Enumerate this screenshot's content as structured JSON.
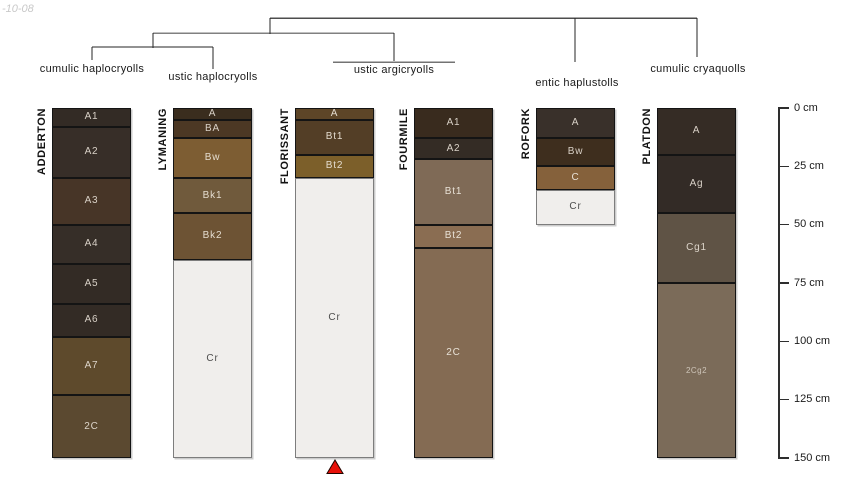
{
  "watermark": "-10-08",
  "dendrogram": {
    "groups": [
      {
        "label": "cumulic haplocryolls",
        "x": 92,
        "y": 63
      },
      {
        "label": "ustic haplocryolls",
        "x": 213,
        "y": 71
      },
      {
        "label": "ustic argicryolls",
        "x": 394,
        "y": 64
      },
      {
        "label": "entic haplustolls",
        "x": 577,
        "y": 77
      },
      {
        "label": "cumulic cryaquolls",
        "x": 698,
        "y": 63
      }
    ]
  },
  "profiles": [
    {
      "name": "ADDERTON",
      "x": 52,
      "group": "cumulic haplocryolls",
      "horizons": [
        {
          "label": "A1",
          "top_cm": 0,
          "bottom_cm": 8,
          "color": "#332b25",
          "label_color": "#d9d1c7"
        },
        {
          "label": "A2",
          "top_cm": 8,
          "bottom_cm": 30,
          "color": "#372e28",
          "label_color": "#d9d1c7"
        },
        {
          "label": "A3",
          "top_cm": 30,
          "bottom_cm": 50,
          "color": "#473527",
          "label_color": "#d9d1c7"
        },
        {
          "label": "A4",
          "top_cm": 50,
          "bottom_cm": 67,
          "color": "#362e28",
          "label_color": "#d9d1c7"
        },
        {
          "label": "A5",
          "top_cm": 67,
          "bottom_cm": 84,
          "color": "#332b25",
          "label_color": "#d9d1c7"
        },
        {
          "label": "A6",
          "top_cm": 84,
          "bottom_cm": 98,
          "color": "#332b25",
          "label_color": "#d9d1c7"
        },
        {
          "label": "A7",
          "top_cm": 98,
          "bottom_cm": 123,
          "color": "#5e4a2c",
          "label_color": "#ddd5ca"
        },
        {
          "label": "2C",
          "top_cm": 123,
          "bottom_cm": 150,
          "color": "#5b4930",
          "label_color": "#ddd5ca"
        }
      ]
    },
    {
      "name": "LYMANING",
      "x": 173,
      "group": "ustic haplocryolls",
      "horizons": [
        {
          "label": "A",
          "top_cm": 0,
          "bottom_cm": 5,
          "color": "#3a2d1e",
          "label_color": "#d9d1c7"
        },
        {
          "label": "BA",
          "top_cm": 5,
          "bottom_cm": 13,
          "color": "#4c3824",
          "label_color": "#d9d1c7"
        },
        {
          "label": "Bw",
          "top_cm": 13,
          "bottom_cm": 30,
          "color": "#7d5d33",
          "label_color": "#e4dccf"
        },
        {
          "label": "Bk1",
          "top_cm": 30,
          "bottom_cm": 45,
          "color": "#705a3c",
          "label_color": "#e4dccf"
        },
        {
          "label": "Bk2",
          "top_cm": 45,
          "bottom_cm": 65,
          "color": "#6d5334",
          "label_color": "#e4dccf"
        },
        {
          "label": "Cr",
          "top_cm": 65,
          "bottom_cm": 150,
          "color": "#f0eeec",
          "label_color": "#4d4d4d"
        }
      ]
    },
    {
      "name": "FLORISSANT",
      "x": 295,
      "group": "ustic argicryolls",
      "horizons": [
        {
          "label": "A",
          "top_cm": 0,
          "bottom_cm": 5,
          "color": "#5d4527",
          "label_color": "#e4dccf"
        },
        {
          "label": "Bt1",
          "top_cm": 5,
          "bottom_cm": 20,
          "color": "#533e26",
          "label_color": "#e4dccf"
        },
        {
          "label": "Bt2",
          "top_cm": 20,
          "bottom_cm": 30,
          "color": "#7c5f2a",
          "label_color": "#e4dccf"
        },
        {
          "label": "Cr",
          "top_cm": 30,
          "bottom_cm": 150,
          "color": "#f0eeec",
          "label_color": "#4d4d4d"
        }
      ]
    },
    {
      "name": "FOURMILE",
      "x": 414,
      "group": "ustic argicryolls",
      "horizons": [
        {
          "label": "A1",
          "top_cm": 0,
          "bottom_cm": 13,
          "color": "#392b1e",
          "label_color": "#d9d1c7"
        },
        {
          "label": "A2",
          "top_cm": 13,
          "bottom_cm": 22,
          "color": "#342c25",
          "label_color": "#d9d1c7"
        },
        {
          "label": "Bt1",
          "top_cm": 22,
          "bottom_cm": 50,
          "color": "#7f6a56",
          "label_color": "#e8e1d6"
        },
        {
          "label": "Bt2",
          "top_cm": 50,
          "bottom_cm": 60,
          "color": "#8a6d52",
          "label_color": "#e8e1d6"
        },
        {
          "label": "2C",
          "top_cm": 60,
          "bottom_cm": 150,
          "color": "#846b53",
          "label_color": "#e8e1d6"
        }
      ]
    },
    {
      "name": "ROFORK",
      "x": 536,
      "group": "entic haplustolls",
      "horizons": [
        {
          "label": "A",
          "top_cm": 0,
          "bottom_cm": 13,
          "color": "#39302a",
          "label_color": "#d9d1c7"
        },
        {
          "label": "Bw",
          "top_cm": 13,
          "bottom_cm": 25,
          "color": "#3e2e1e",
          "label_color": "#d9d1c7"
        },
        {
          "label": "C",
          "top_cm": 25,
          "bottom_cm": 35,
          "color": "#85613b",
          "label_color": "#e8e1d6"
        },
        {
          "label": "Cr",
          "top_cm": 35,
          "bottom_cm": 50,
          "color": "#f0eeec",
          "label_color": "#4d4d4d"
        }
      ]
    },
    {
      "name": "PLATDON",
      "x": 657,
      "group": "cumulic cryaquolls",
      "horizons": [
        {
          "label": "A",
          "top_cm": 0,
          "bottom_cm": 20,
          "color": "#352c25",
          "label_color": "#d9d1c7"
        },
        {
          "label": "Ag",
          "top_cm": 20,
          "bottom_cm": 45,
          "color": "#332b26",
          "label_color": "#d9d1c7"
        },
        {
          "label": "Cg1",
          "top_cm": 45,
          "bottom_cm": 75,
          "color": "#5f5345",
          "label_color": "#ddd5ca"
        },
        {
          "label": "2Cg2",
          "top_cm": 75,
          "bottom_cm": 150,
          "color": "#7b6b59",
          "label_color": "#cfc6ba",
          "small_label": true
        }
      ]
    }
  ],
  "depth_scale": {
    "ticks": [
      {
        "cm": 0,
        "label": "0 cm"
      },
      {
        "cm": 25,
        "label": "25 cm"
      },
      {
        "cm": 50,
        "label": "50 cm"
      },
      {
        "cm": 75,
        "label": "75 cm"
      },
      {
        "cm": 100,
        "label": "100 cm"
      },
      {
        "cm": 125,
        "label": "125 cm"
      },
      {
        "cm": 150,
        "label": "150 cm"
      }
    ]
  },
  "marker": {
    "symbol": "red-triangle-up",
    "color": "#e81109",
    "under_profile": "FLORISSANT"
  }
}
